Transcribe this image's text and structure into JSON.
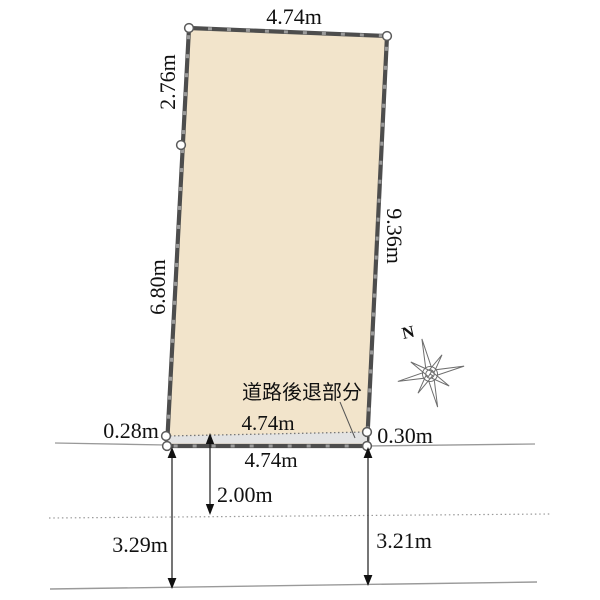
{
  "diagram": {
    "title_hint": "land-plot-survey-diagram",
    "labels": {
      "top_width": "4.74m",
      "left_upper_side": "2.76m",
      "left_lower_side": "6.80m",
      "right_side": "9.36m",
      "setback_left": "0.28m",
      "setback_right": "0.30m",
      "setback_area": "道路後退部分",
      "setback_frontage": "4.74m",
      "frontage": "4.74m",
      "road_center_offset": "2.00m",
      "road_width_left": "3.29m",
      "road_width_right": "3.21m",
      "compass_north": "N"
    },
    "colors": {
      "plot_fill": "#f2e4cb",
      "plot_border": "#4d4d4d",
      "plot_border_dash": "#9b9b9b",
      "setback_fill": "#e3e3e3",
      "road_line": "#999999",
      "dimension_line": "#1a1a1a",
      "vertex_fill": "#ffffff",
      "vertex_stroke": "#5a5a5a",
      "compass_stroke": "#6e6e6e"
    }
  }
}
